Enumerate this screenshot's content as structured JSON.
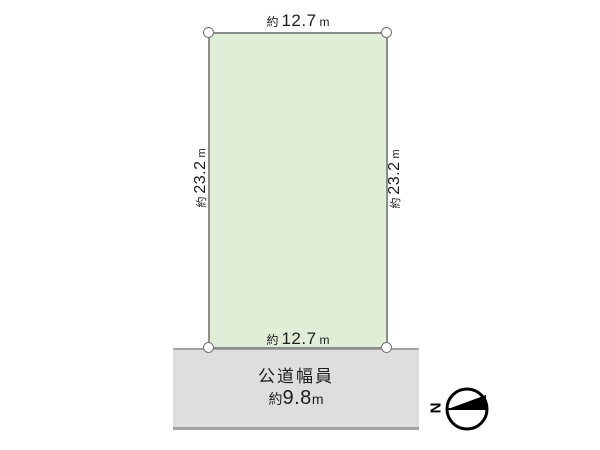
{
  "diagram": {
    "parcel": {
      "fill": "#e0eed7",
      "border_color": "#8b8f89",
      "dimensions": {
        "top": {
          "prefix": "約",
          "value": "12.7",
          "unit": "m"
        },
        "bottom": {
          "prefix": "約",
          "value": "12.7",
          "unit": "m"
        },
        "left": {
          "prefix": "約",
          "value": "23.2",
          "unit": "m"
        },
        "right": {
          "prefix": "約",
          "value": "23.2",
          "unit": "m"
        }
      }
    },
    "road": {
      "fill": "#dedede",
      "edge_color": "#a3a3a3",
      "name": "公道幅員",
      "width": {
        "prefix": "約",
        "value": "9.8",
        "unit": "m"
      }
    },
    "compass": {
      "letter": "N"
    }
  }
}
